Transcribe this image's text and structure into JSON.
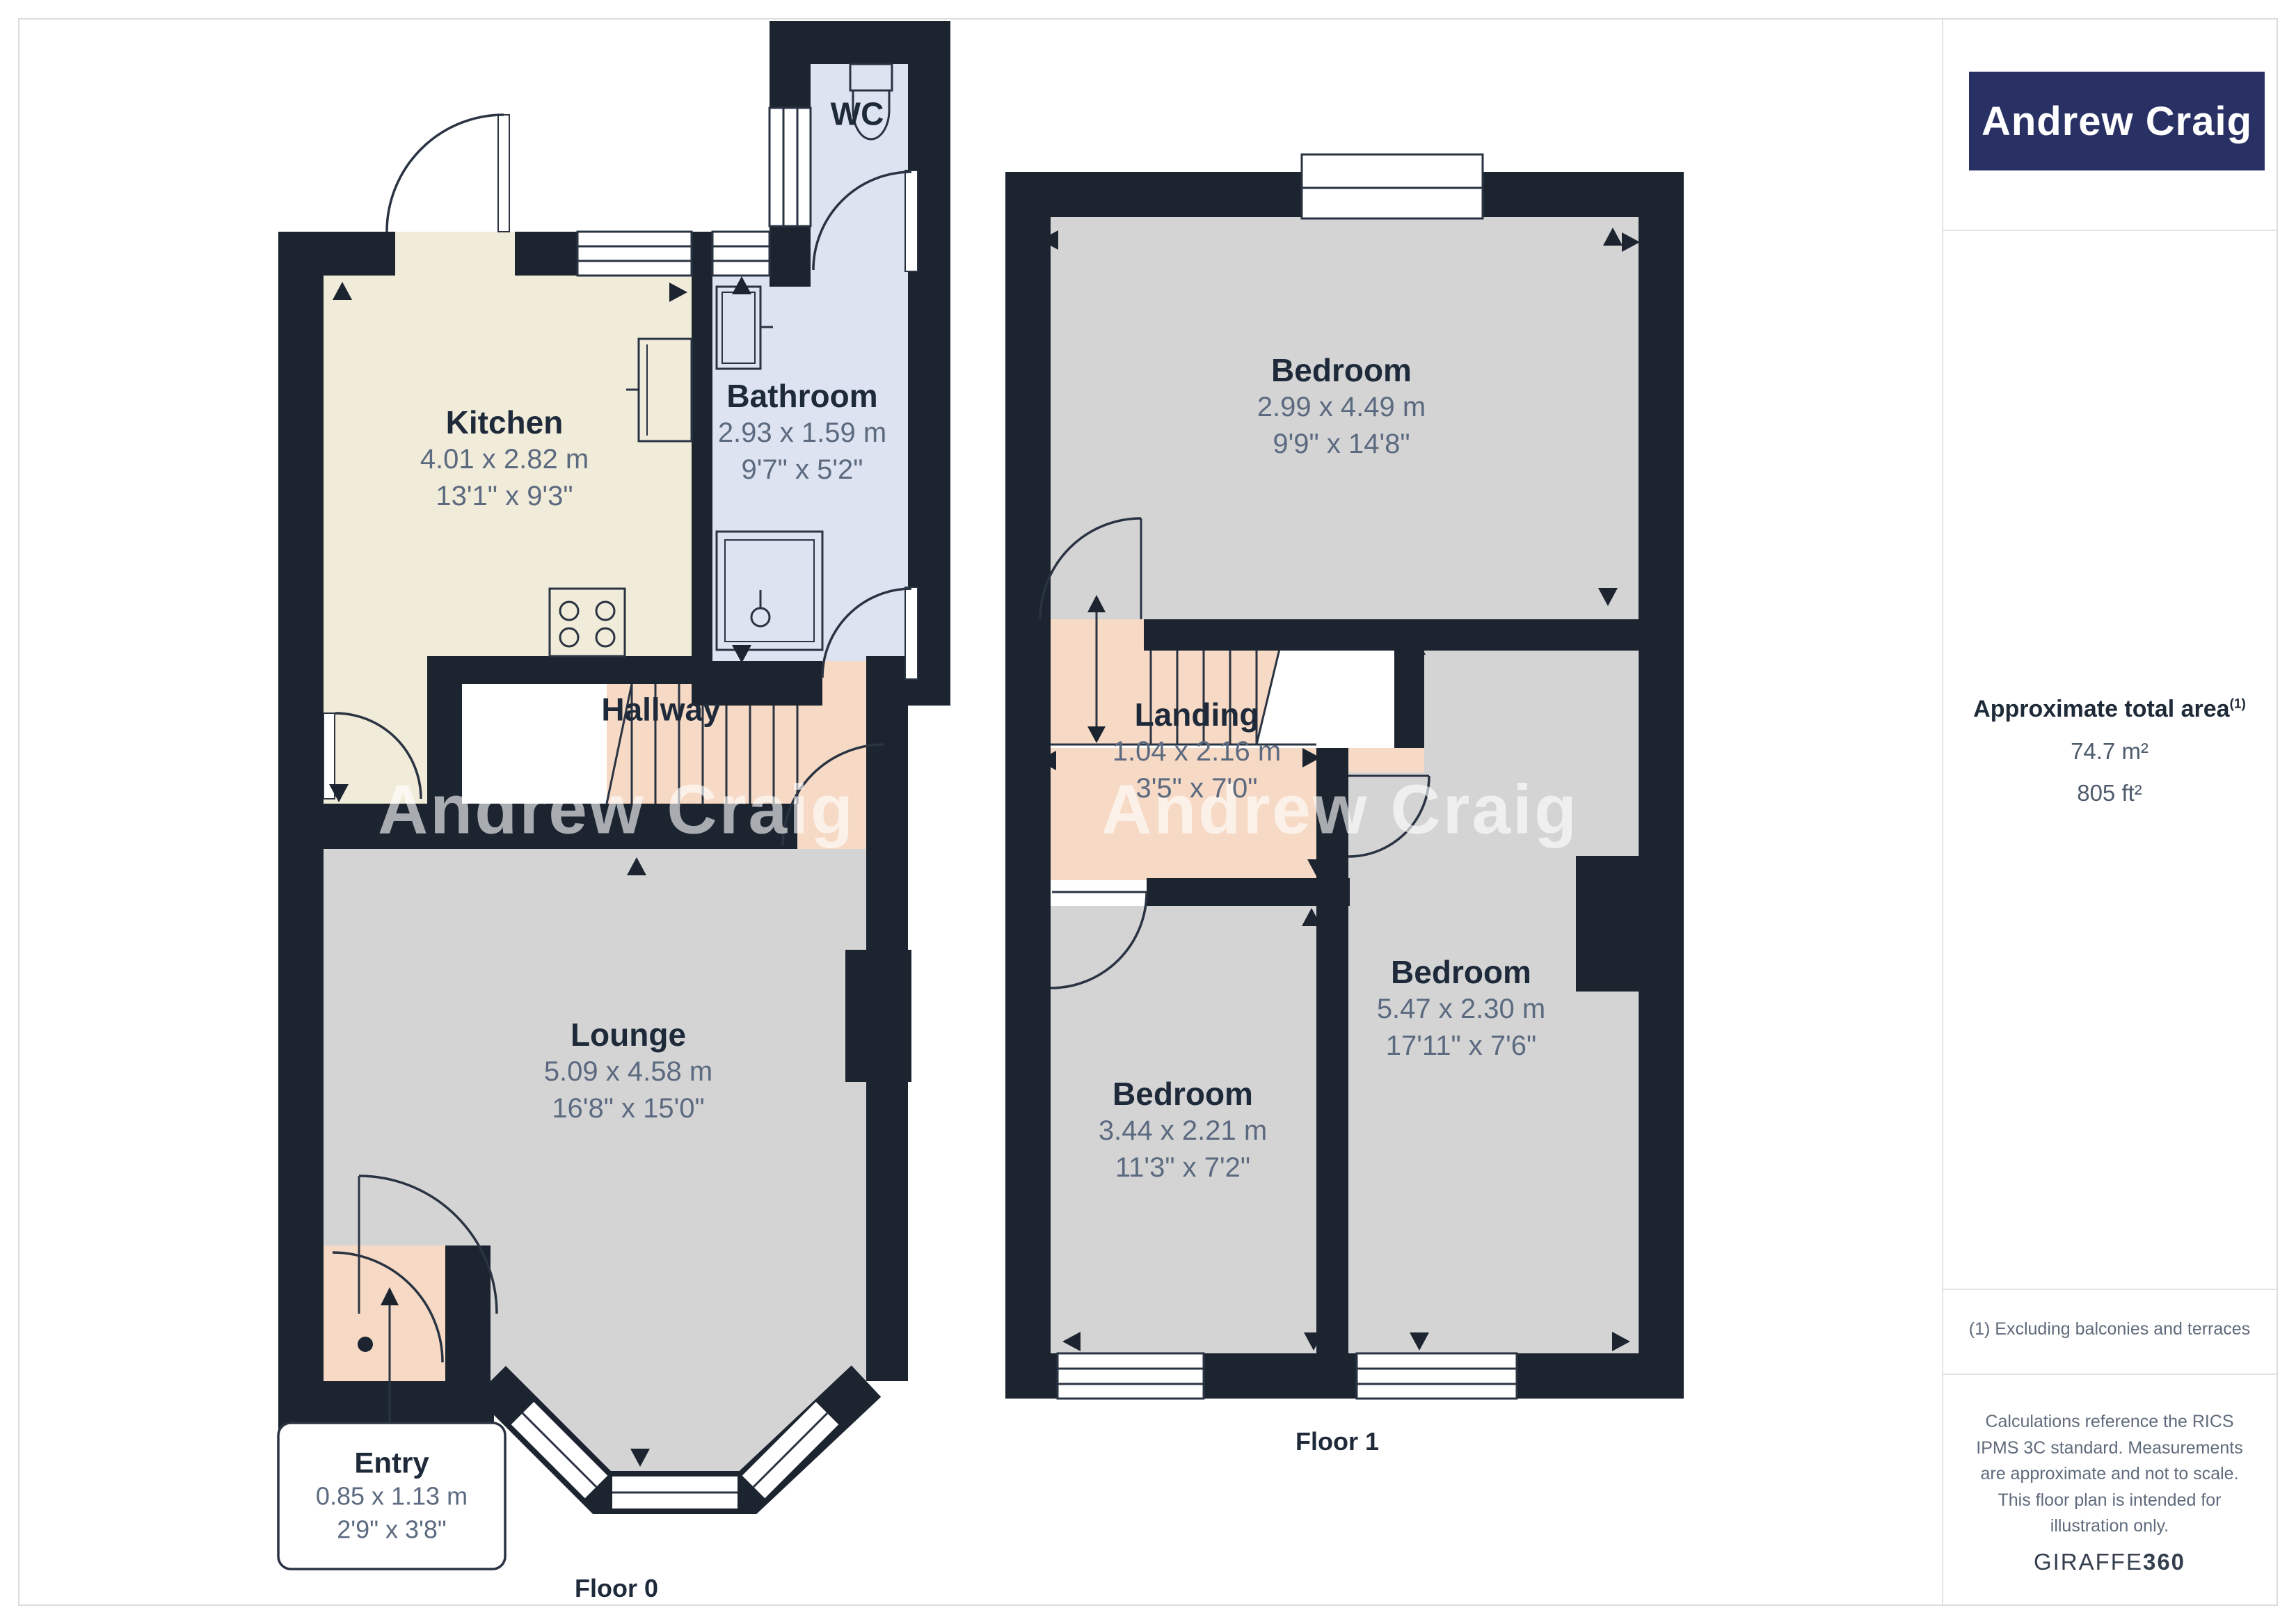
{
  "branding": {
    "logo_text": "Andrew Craig"
  },
  "watermark": {
    "text": "Andrew Craig"
  },
  "floor0": {
    "label": "Floor 0",
    "rooms": {
      "kitchen": {
        "name": "Kitchen",
        "metric": "4.01 x 2.82 m",
        "imperial": "13'1\" x 9'3\""
      },
      "bathroom": {
        "name": "Bathroom",
        "metric": "2.93 x 1.59 m",
        "imperial": "9'7\" x 5'2\""
      },
      "wc": {
        "name": "WC"
      },
      "hallway": {
        "name": "Hallway"
      },
      "lounge": {
        "name": "Lounge",
        "metric": "5.09 x 4.58 m",
        "imperial": "16'8\" x 15'0\""
      },
      "entry": {
        "name": "Entry",
        "metric": "0.85 x 1.13 m",
        "imperial": "2'9\" x 3'8\""
      }
    }
  },
  "floor1": {
    "label": "Floor 1",
    "rooms": {
      "bedroom_top": {
        "name": "Bedroom",
        "metric": "2.99 x 4.49 m",
        "imperial": "9'9\" x 14'8\""
      },
      "landing": {
        "name": "Landing",
        "metric": "1.04 x 2.16 m",
        "imperial": "3'5\" x 7'0\""
      },
      "bedroom_left": {
        "name": "Bedroom",
        "metric": "3.44 x 2.21 m",
        "imperial": "11'3\" x 7'2\""
      },
      "bedroom_right": {
        "name": "Bedroom",
        "metric": "5.47 x 2.30 m",
        "imperial": "17'11\" x 7'6\""
      }
    }
  },
  "sidebar": {
    "area_title": "Approximate total area",
    "area_marker": "(1)",
    "area_metric": "74.7 m²",
    "area_imperial": "805 ft²",
    "footnote": "(1) Excluding balconies and terraces",
    "disclaimer": "Calculations reference the RICS IPMS 3C standard. Measurements are approximate and not to scale. This floor plan is intended for illustration only.",
    "provider_plain": "GIRAFFE",
    "provider_bold": "360"
  },
  "colors": {
    "wall": "#1c2430",
    "kitchen_floor": "#f1ecd9",
    "bathroom_floor": "#dde3f0",
    "hall_floor": "#f6dac5",
    "room_floor": "#d4d4d5",
    "brand_navy": "#293064",
    "label_title": "#1e2a3a",
    "label_dims": "#5c6a80"
  }
}
